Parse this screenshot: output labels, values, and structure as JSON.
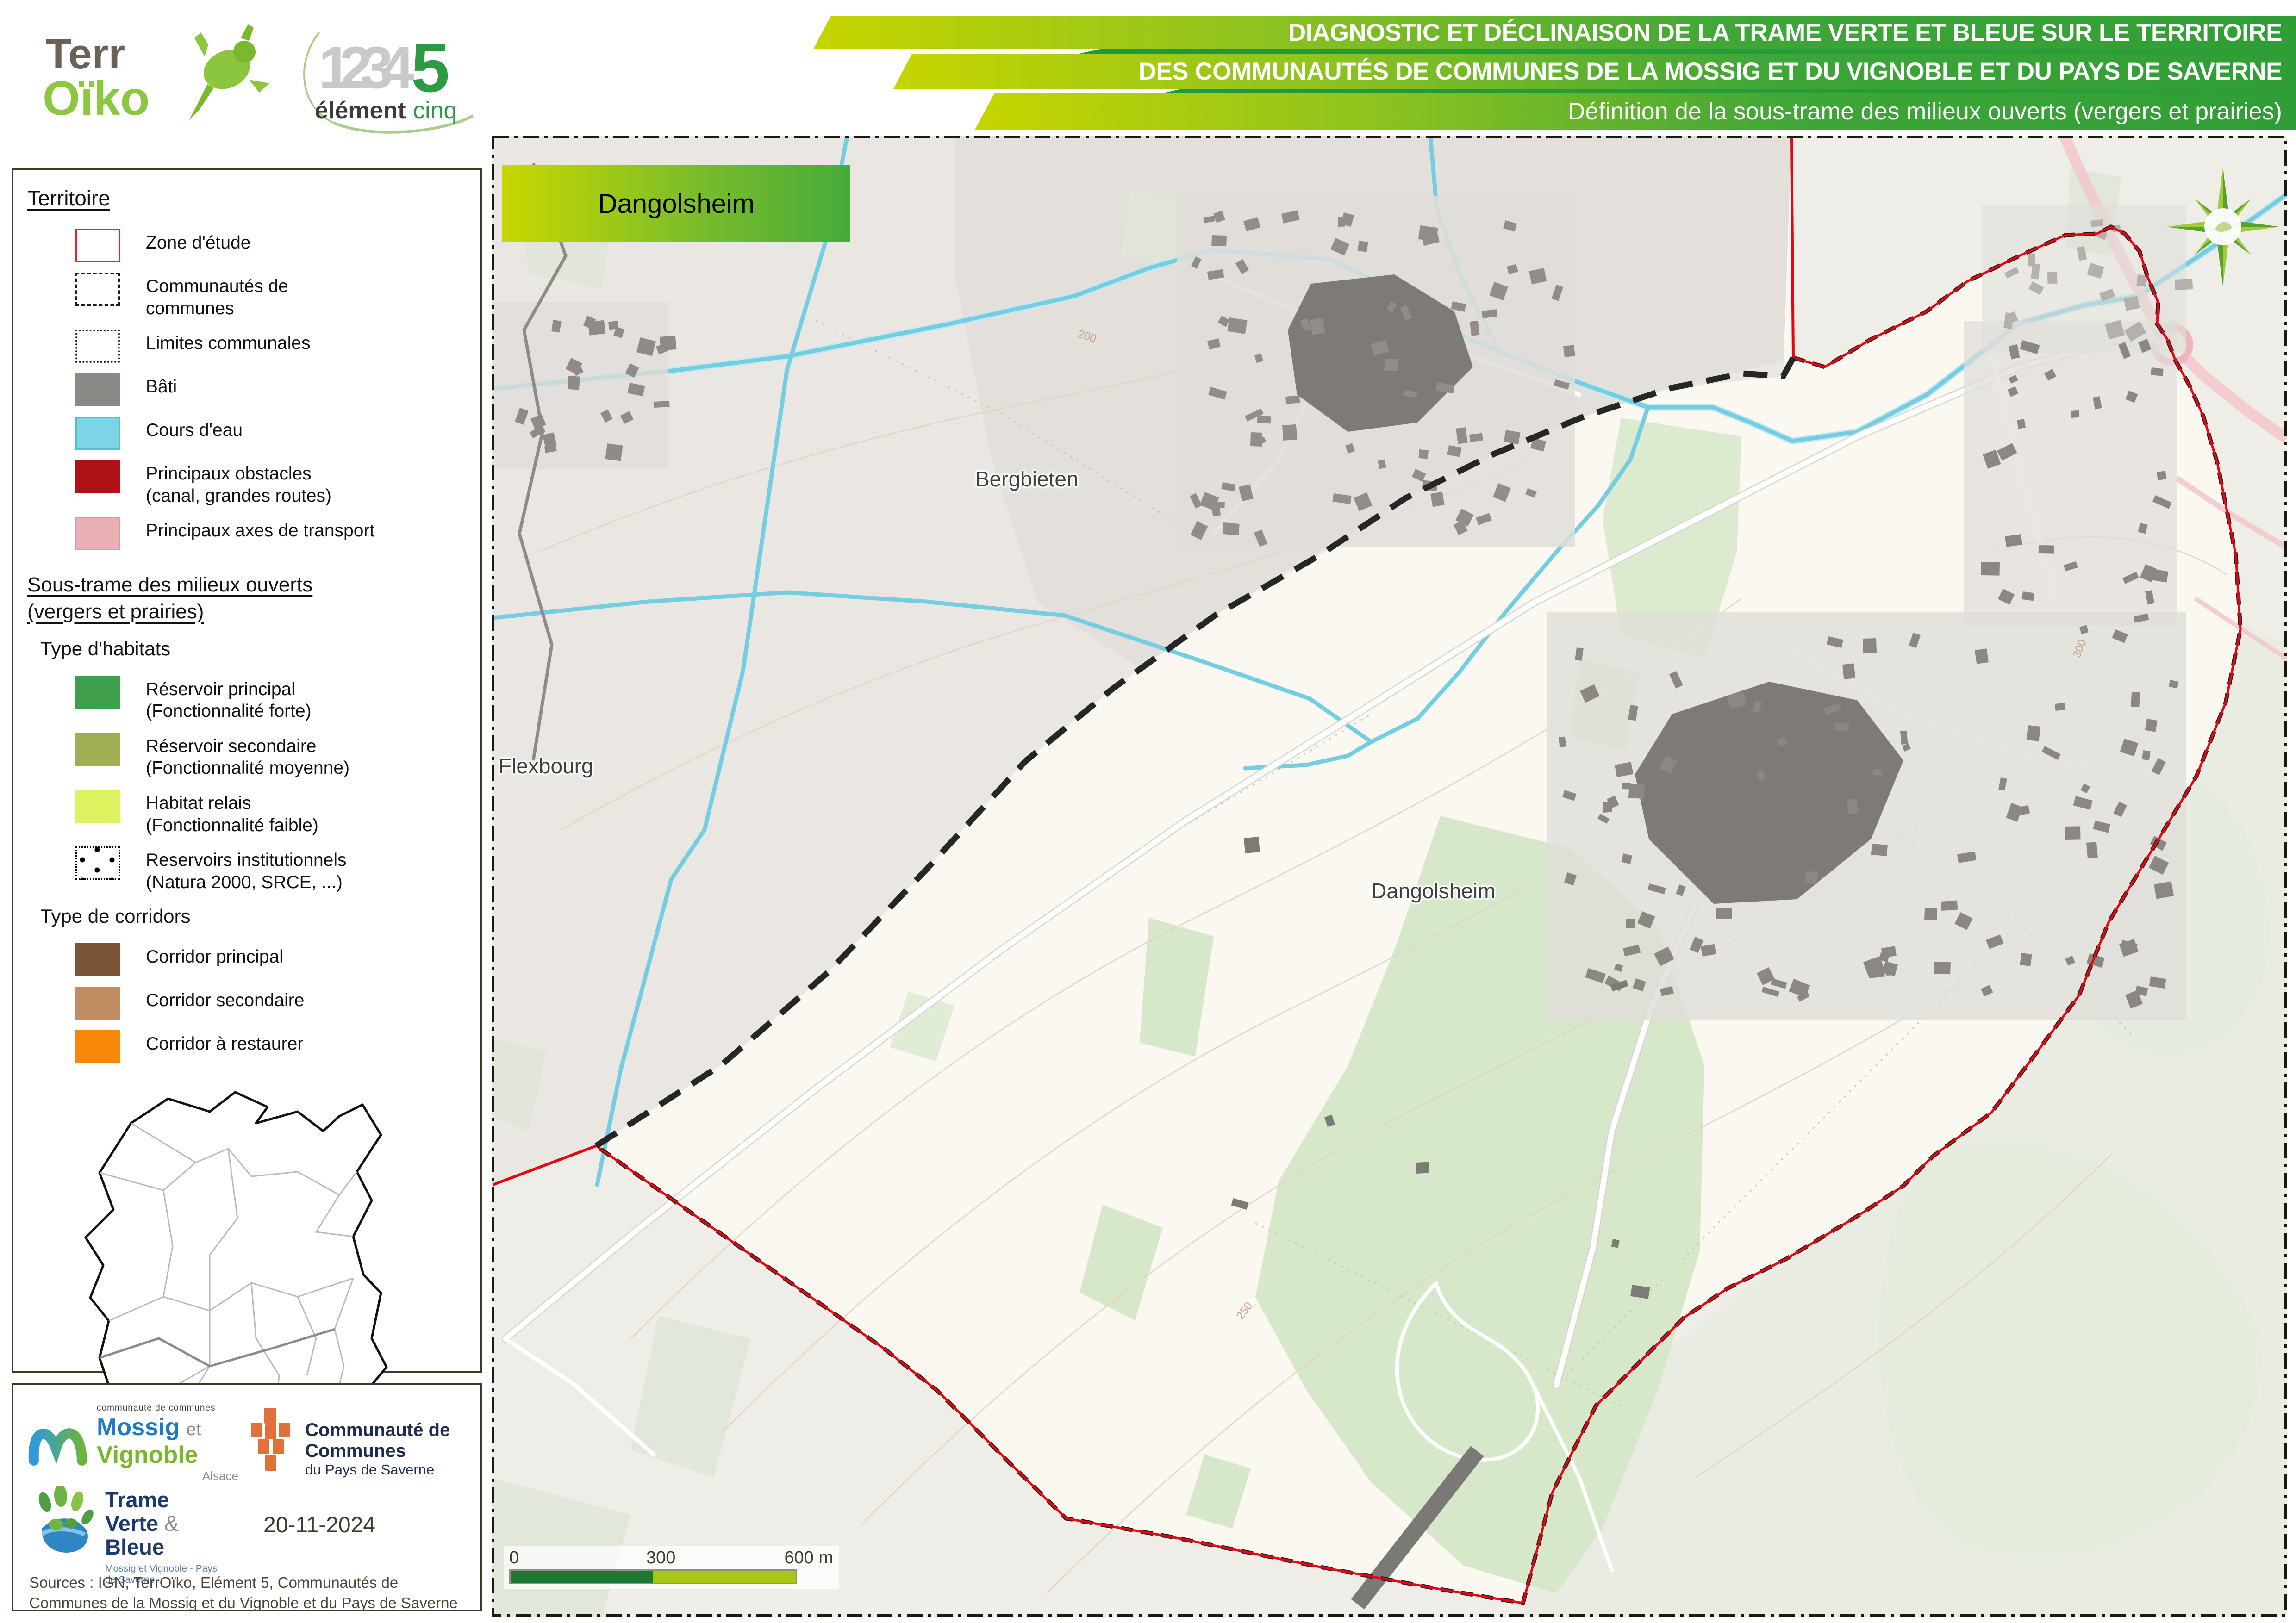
{
  "header": {
    "terroiko_logo": {
      "part1": "Terr",
      "part2": "Oïko"
    },
    "element5_logo": {
      "numbers": "1234",
      "five": "5",
      "word1": "élément",
      "word2": "cinq"
    },
    "banners": [
      "DIAGNOSTIC ET DÉCLINAISON DE LA TRAME VERTE ET BLEUE SUR LE TERRITOIRE",
      "DES COMMUNAUTÉS DE COMMUNES DE LA MOSSIG ET DU VIGNOBLE ET DU PAYS DE SAVERNE",
      "Définition de la sous-trame des milieux ouverts (vergers et prairies)"
    ]
  },
  "legend": {
    "section1_title": "Territoire",
    "territoire_items": [
      {
        "label": "Zone d'étude",
        "label2": "",
        "fill": "#ffffff",
        "border": "#e8212e",
        "borderStyle": "solid",
        "borderW": "3px"
      },
      {
        "label": "Communautés de",
        "label2": "communes",
        "fill": "#ffffff",
        "border": "#1a1a1a",
        "borderStyle": "dashed",
        "borderW": "4px"
      },
      {
        "label": "Limites communales",
        "label2": "",
        "fill": "#ffffff",
        "border": "#1a1a1a",
        "borderStyle": "dotted",
        "borderW": "4px"
      },
      {
        "label": "Bâti",
        "label2": "",
        "fill": "#8c8a86",
        "border": "",
        "borderStyle": "",
        "borderW": ""
      },
      {
        "label": "Cours d'eau",
        "label2": "",
        "fill": "#7cd4e4",
        "border": "#54bcd4",
        "borderStyle": "solid",
        "borderW": "3px"
      },
      {
        "label": "Principaux obstacles",
        "label2": "(canal, grandes routes)",
        "fill": "#b01116",
        "border": "",
        "borderStyle": "",
        "borderW": ""
      },
      {
        "label": "Principaux axes de transport",
        "label2": "",
        "fill": "#e9b0b6",
        "border": "#d898a0",
        "borderStyle": "solid",
        "borderW": "2px"
      }
    ],
    "section2_title1": "Sous-trame des milieux ouverts",
    "section2_title2": "(vergers et prairies)",
    "habitats_title": "Type d'habitats",
    "habitat_items": [
      {
        "label": "Réservoir principal",
        "label2": "(Fonctionnalité forte)",
        "fill": "#3f9f4c",
        "border": "",
        "borderStyle": "",
        "borderW": ""
      },
      {
        "label": "Réservoir secondaire",
        "label2": "(Fonctionnalité moyenne)",
        "fill": "#a2ae53",
        "border": "",
        "borderStyle": "",
        "borderW": ""
      },
      {
        "label": "Habitat relais",
        "label2": "(Fonctionnalité faible)",
        "fill": "#def25f",
        "border": "",
        "borderStyle": "",
        "borderW": ""
      },
      {
        "label": "Reservoirs institutionnels",
        "label2": "(Natura 2000, SRCE, ...)",
        "fill": "#ffffff",
        "border": "#000000",
        "borderStyle": "dotted",
        "borderW": "3px",
        "dots": true
      }
    ],
    "corridors_title": "Type de corridors",
    "corridor_items": [
      {
        "label": "Corridor principal",
        "label2": "",
        "fill": "#7c5538",
        "border": "",
        "borderStyle": "",
        "borderW": ""
      },
      {
        "label": "Corridor secondaire",
        "label2": "",
        "fill": "#c08d63",
        "border": "",
        "borderStyle": "",
        "borderW": ""
      },
      {
        "label": "Corridor à restaurer",
        "label2": "",
        "fill": "#f78708",
        "border": "",
        "borderStyle": "",
        "borderW": ""
      }
    ]
  },
  "map": {
    "title_box": "Dangolsheim",
    "labels": {
      "bergbieten": "Bergbieten",
      "flexbourg": "Flexbourg",
      "dangolsheim": "Dangolsheim"
    },
    "contour_labels": [
      "200",
      "250",
      "300"
    ],
    "scalebar": {
      "t0": "0",
      "t300": "300",
      "t600": "600 m"
    },
    "colors": {
      "study_boundary": "#e30613",
      "commune_dash": "#1f1f1f",
      "inside_fill": "#faf8f0",
      "outside_fill": "#eceae5",
      "water": "#74cde1",
      "vegetation": "#d6e7ca",
      "built": "#8b8884",
      "transport_pink": "#f2c6cb"
    }
  },
  "footer": {
    "mossig_logo": {
      "top": "communauté de communes",
      "w1": "Mossig",
      "et": "et",
      "w2": "Vignoble",
      "sub": "Alsace"
    },
    "saverne_logo": {
      "l1": "Communauté de Communes",
      "l2": "du Pays de Saverne"
    },
    "tvb_logo": {
      "l1": "Trame",
      "l2a": "Verte",
      "amp": "&",
      "l2b": "Bleue",
      "sub": "Mossig et Vignoble - Pays de Saverne"
    },
    "date": "20-11-2024",
    "sources": "Sources : IGN, TerrOïko, Elément 5, Communautés de Communes de la Mossig et du Vignoble et du Pays de Saverne"
  }
}
